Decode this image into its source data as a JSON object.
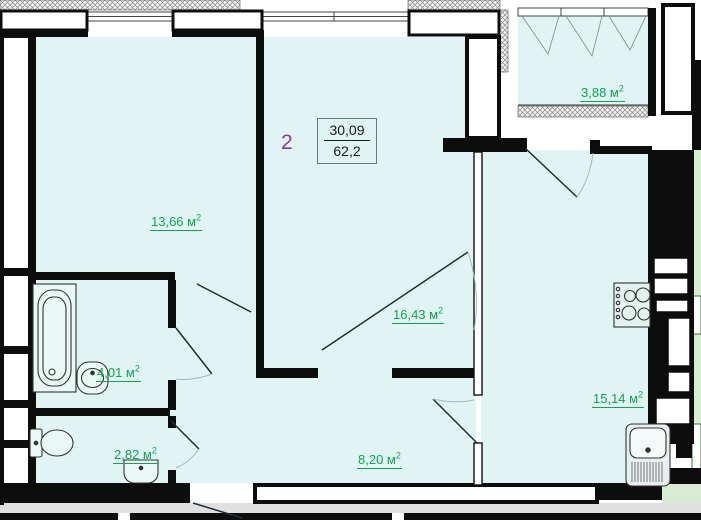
{
  "plan": {
    "unit_number": "2",
    "area_box": {
      "upper": "30,09",
      "lower": "62,2"
    },
    "rooms": [
      {
        "name": "living-room",
        "area": "13,66",
        "unit": " м",
        "sup": "2"
      },
      {
        "name": "bedroom",
        "area": "16,43",
        "unit": " м",
        "sup": "2"
      },
      {
        "name": "balcony",
        "area": "3,88",
        "unit": " м",
        "sup": "2"
      },
      {
        "name": "kitchen",
        "area": "15,14",
        "unit": " м",
        "sup": "2"
      },
      {
        "name": "bathroom",
        "area": "4,01",
        "unit": " м",
        "sup": "2"
      },
      {
        "name": "wc",
        "area": "2,82",
        "unit": " м",
        "sup": "2"
      },
      {
        "name": "hallway",
        "area": "8,20",
        "unit": " м",
        "sup": "2"
      }
    ],
    "colors": {
      "room_fill": "#e0f5f3",
      "label_green": "#12a251",
      "unit_purple": "#8b3a96",
      "wall_black": "#0d0d0d",
      "neighbor_green": "#d8ecd4",
      "corridor_gray": "#e0e0e0"
    }
  }
}
